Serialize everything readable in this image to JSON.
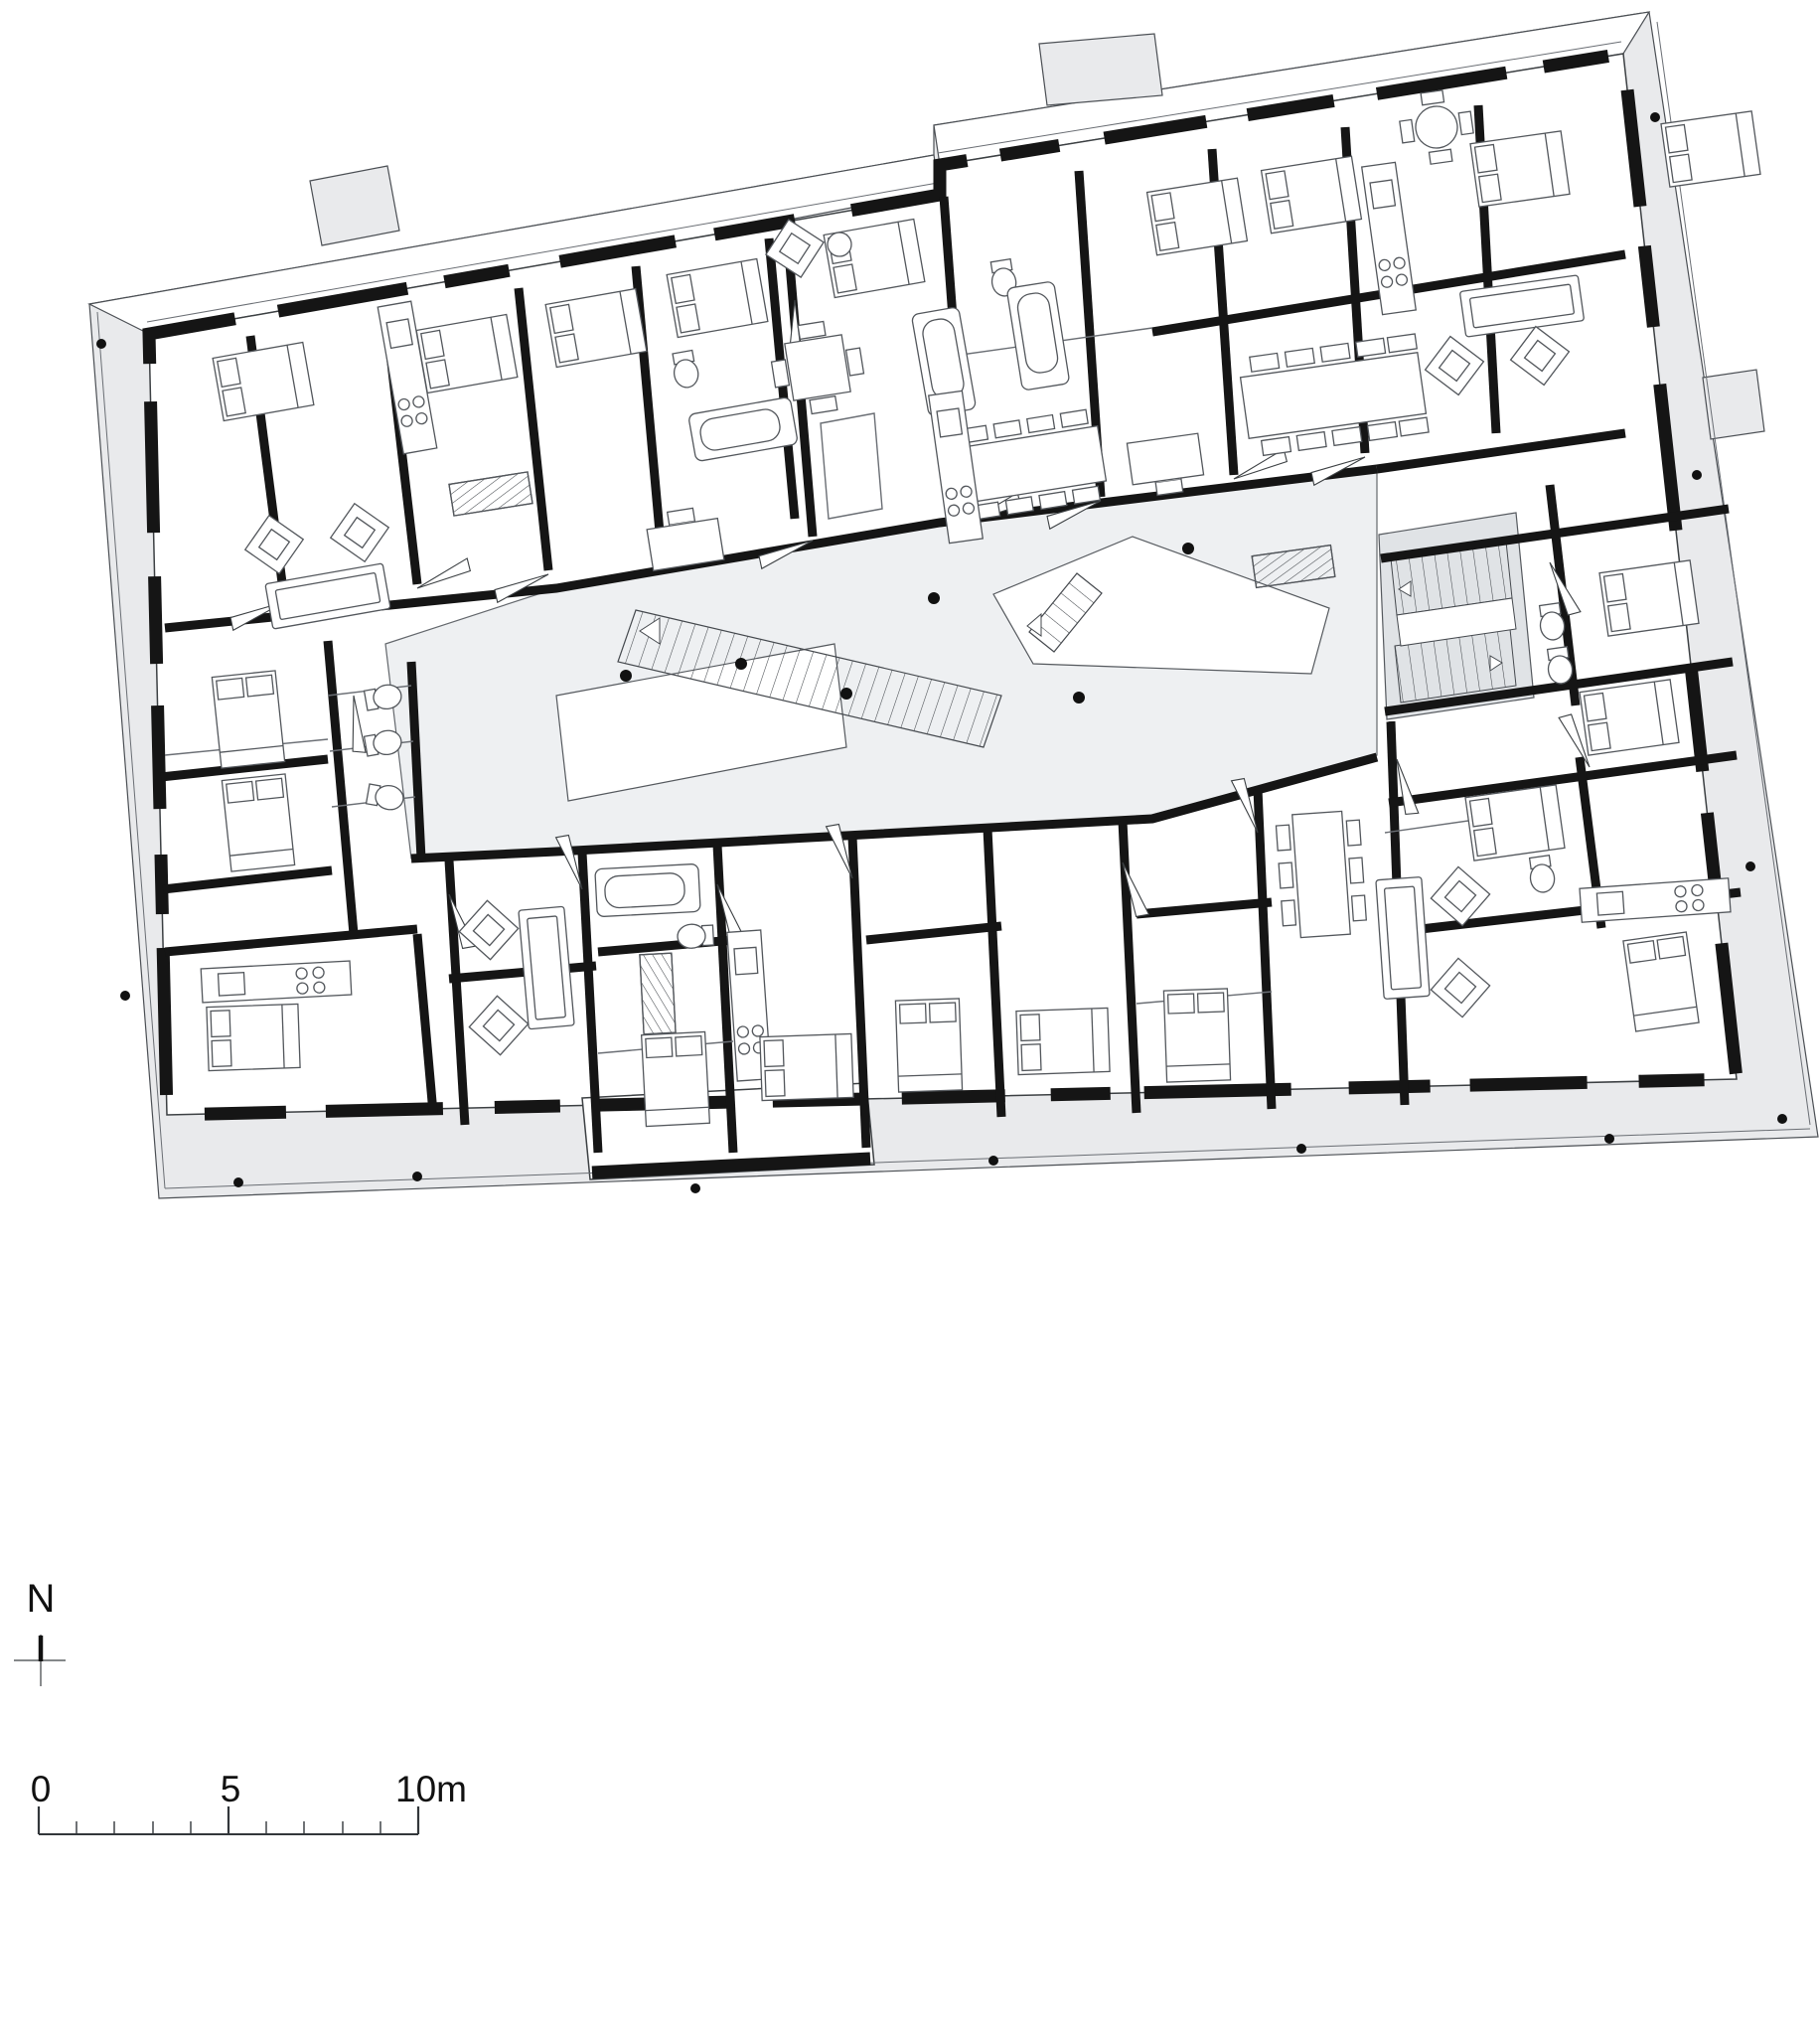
{
  "north_indicator": {
    "label": "N"
  },
  "scale_bar": {
    "tick_labels": [
      "0",
      "5",
      "10m"
    ],
    "total_meters": 10,
    "divisions": 10
  },
  "palette": {
    "paper": "#ffffff",
    "terrace": "#e9eaec",
    "atrium": "#eef0f2",
    "stair_core": "#e0e3e6",
    "wall": "#151515",
    "outline": "#4b4f54",
    "thin_line": "#6a6e74",
    "furniture": "#53575c",
    "column_dot": "#111111",
    "text": "#111111"
  }
}
